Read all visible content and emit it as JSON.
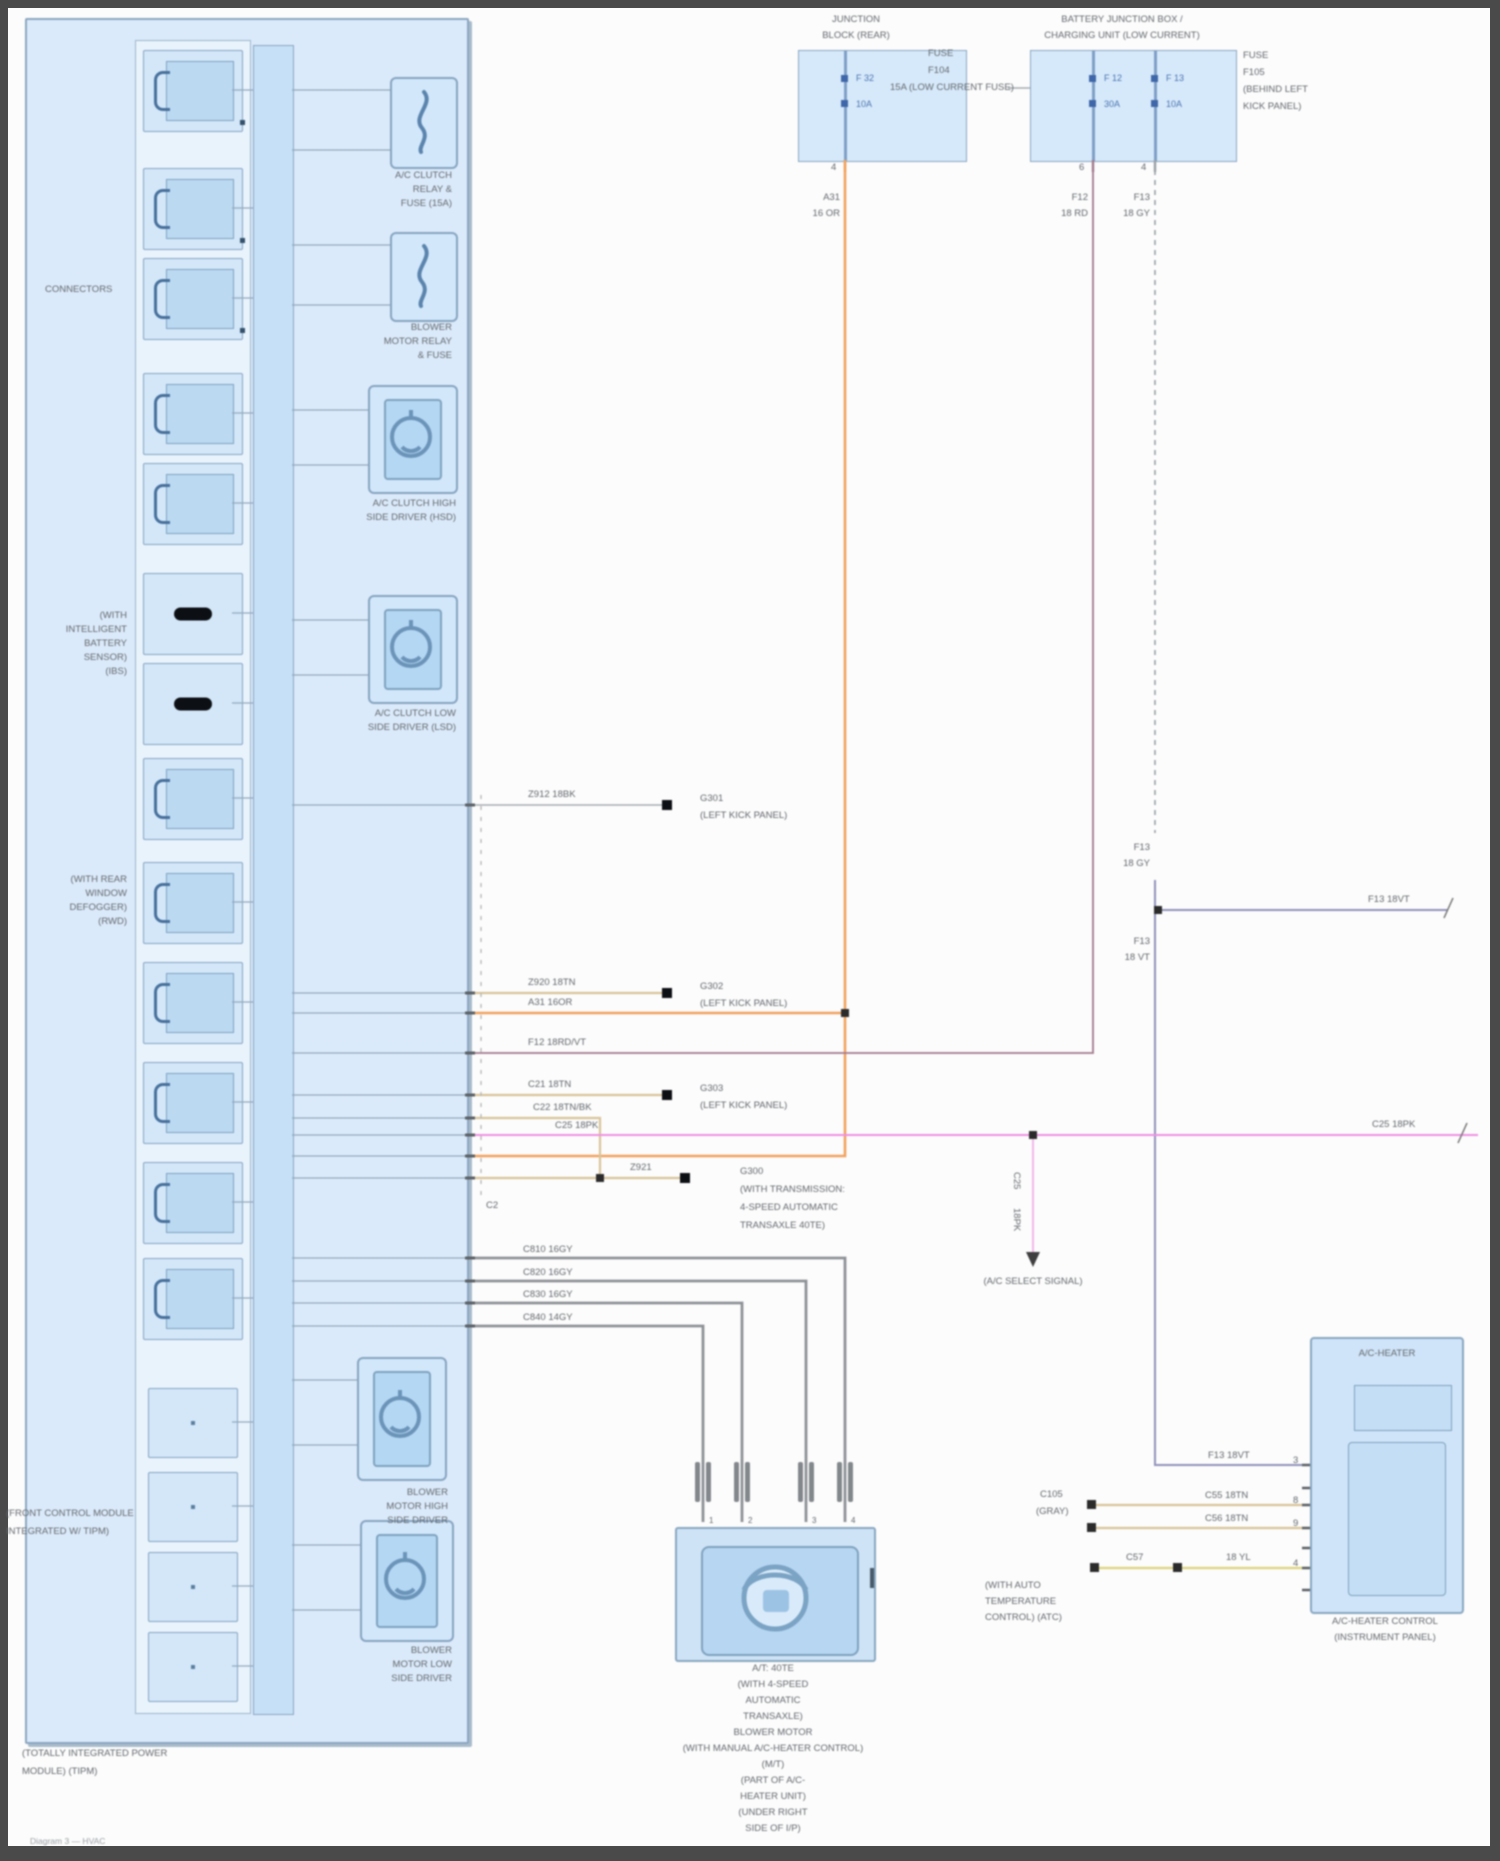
{
  "colors": {
    "panel_fill": "#dbeafa",
    "panel_border": "#8ba6c0",
    "block_fill": "#d3e7f9",
    "bus_fill": "#c6e0f8",
    "wire_orange": "#f2a25e",
    "wire_tan": "#d9c49a",
    "wire_gray": "#a7adb3",
    "wire_slate": "#8f93bb",
    "wire_mauve": "#a2798c",
    "wire_pink": "#ef8fe3",
    "wire_yellow": "#ddd37f",
    "wire_blower": "#8e9296",
    "text": "#63686e",
    "accent_blue": "#4a72b0",
    "ground": "#0c0f14"
  },
  "labels": {
    "h1": [
      "JUNCTION",
      "BLOCK (REAR)"
    ],
    "h1r": [
      "FUSE",
      "F104",
      "15A (LOW CURRENT FUSE)"
    ],
    "h2": [
      "BATTERY JUNCTION BOX /",
      "CHARGING UNIT (LOW CURRENT)"
    ],
    "h2r": [
      "FUSE",
      "F105",
      "(BEHIND LEFT",
      "KICK PANEL)"
    ],
    "fuse1_id": "F 32",
    "fuse1_amp": "10A",
    "fuse2_id": "F 12",
    "fuse2_amp": "30A",
    "fuse3_id": "F 13",
    "fuse3_amp": "10A",
    "pin_b1": "4",
    "pin_b2a": "6",
    "pin_b2b": "4",
    "wc_or": [
      "A31",
      "16 OR"
    ],
    "wc_rd": [
      "F12",
      "18 RD"
    ],
    "wc_gy": [
      "F13",
      "18 GY"
    ],
    "wc_gy2": [
      "F13",
      "18 GY"
    ],
    "wc_vt": [
      "F13",
      "18 VT"
    ],
    "off_slate": "F13 18VT",
    "off_pink": "C25 18PK",
    "wl": [
      "Z912 18BK",
      "Z920 18TN",
      "A31 16OR",
      "F12 18RD/VT",
      "C21 18TN",
      "C22 18TN/BK",
      "C25 18PK",
      "Z921"
    ],
    "gy": [
      "C810 16GY",
      "C820 16GY",
      "C830 16GY",
      "C840 14GY"
    ],
    "g1": [
      "G301",
      "(LEFT KICK PANEL)"
    ],
    "g2": [
      "G302",
      "(LEFT KICK PANEL)"
    ],
    "g3": [
      "G303",
      "(LEFT KICK PANEL)"
    ],
    "g4": [
      "G300",
      "(WITH TRANSMISSION:",
      "4-SPEED AUTOMATIC",
      "TRANSAXLE 40TE)"
    ],
    "c2": "C2",
    "pinkv": [
      "C25",
      "18PK"
    ],
    "pink_arrow": "(A/C SELECT SIGNAL)",
    "conn": [
      "C105",
      "(GRAY)"
    ],
    "tan1": "C55 18TN",
    "tan2": "C56 18TN",
    "yl1": "C57",
    "yl2": "18 YL",
    "atc": [
      "(WITH AUTO",
      "TEMPERATURE",
      "CONTROL) (ATC)"
    ],
    "slate_in": "F13 18VT",
    "pr": [
      "3",
      "8",
      "9",
      "4"
    ],
    "bp": [
      "1",
      "2",
      "3",
      "4"
    ]
  },
  "tipm": {
    "edge": "CONNECTORS",
    "noteA": [
      "(WITH",
      "INTELLIGENT",
      "BATTERY",
      "SENSOR)",
      "(IBS)"
    ],
    "noteB": [
      "(WITH REAR",
      "WINDOW",
      "DEFOGGER)",
      "(RWD)"
    ],
    "noteC": [
      "(FRONT CONTROL MODULE",
      "INTEGRATED W/ TIPM)"
    ],
    "cap": [
      "(TOTALLY INTEGRATED POWER",
      "MODULE) (TIPM)"
    ],
    "f1cap": [
      "A/C CLUTCH",
      "RELAY &",
      "FUSE (15A)"
    ],
    "f2cap": [
      "BLOWER",
      "MOTOR RELAY",
      "& FUSE"
    ],
    "c3cap": [
      "A/C CLUTCH HIGH",
      "SIDE DRIVER (HSD)"
    ],
    "c4cap": [
      "A/C CLUTCH LOW",
      "SIDE DRIVER (LSD)"
    ],
    "c5cap": [
      "BLOWER",
      "MOTOR HIGH",
      "SIDE DRIVER"
    ],
    "c6cap": [
      "BLOWER",
      "MOTOR LOW",
      "SIDE DRIVER"
    ]
  },
  "acbox": {
    "title": "A/C-HEATER",
    "cap": [
      "A/C-HEATER CONTROL",
      "(INSTRUMENT PANEL)"
    ]
  },
  "blower": {
    "cap": [
      "A/T: 40TE",
      "(WITH 4-SPEED",
      "AUTOMATIC",
      "TRANSAXLE)",
      "BLOWER MOTOR",
      "(WITH MANUAL A/C-HEATER CONTROL)",
      "(M/T)",
      "(PART OF A/C-",
      "HEATER UNIT)",
      "(UNDER RIGHT",
      "SIDE OF I/P)"
    ]
  },
  "watermark": "Diagram 3 — HVAC"
}
